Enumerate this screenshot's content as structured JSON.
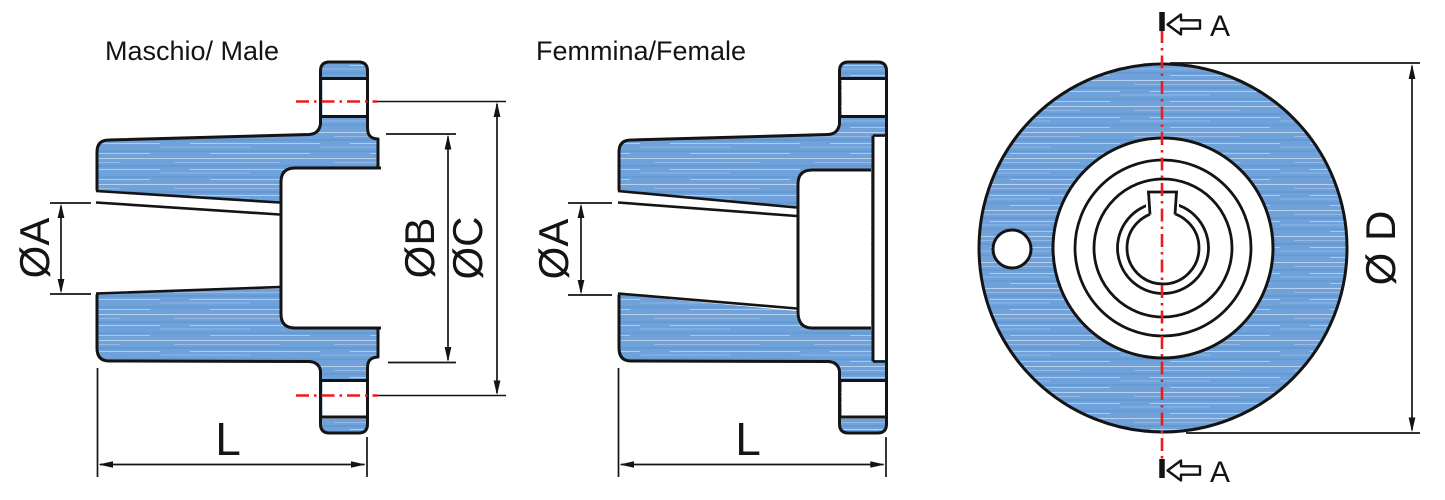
{
  "views": {
    "male": {
      "title": "Maschio/ Male",
      "dim_a": "ØA",
      "dim_b": "ØB",
      "dim_c": "ØC",
      "dim_l": "L"
    },
    "female": {
      "title": "Femmina/Female",
      "dim_a": "ØA",
      "dim_l": "L"
    },
    "front": {
      "dim_d": "Ø D",
      "section_top": "A",
      "section_bottom": "A"
    }
  },
  "colors": {
    "material_blue": "#6FA2DB",
    "outline_black": "#141414",
    "centerline_red": "#ED1C1C"
  }
}
